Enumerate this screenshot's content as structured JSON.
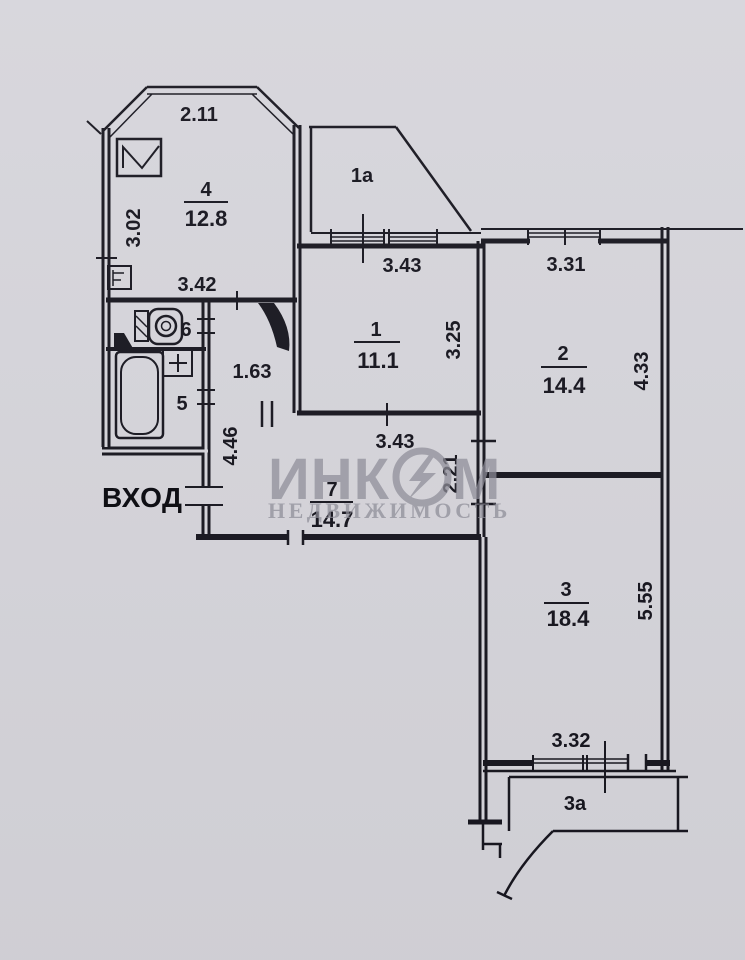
{
  "entrance_label": "ВХОД",
  "watermark": {
    "brand_full": "ИНКОМ",
    "brand_part1": "ИНК",
    "brand_part2": "М",
    "subtitle": "НЕДВИЖИМОСТЬ"
  },
  "rooms": {
    "r1": {
      "number": "1",
      "area": "11.1"
    },
    "r1a": {
      "number": "1a"
    },
    "r2": {
      "number": "2",
      "area": "14.4"
    },
    "r3": {
      "number": "3",
      "area": "18.4"
    },
    "r3a": {
      "number": "3a"
    },
    "r4": {
      "number": "4",
      "area": "12.8"
    },
    "r5": {
      "number": "5"
    },
    "r6": {
      "number": "6"
    },
    "r7": {
      "number": "7",
      "area": "14.7"
    }
  },
  "dimensions": {
    "room4_top": "2.11",
    "room4_left": "3.02",
    "room4_bottom": "3.42",
    "room1_top": "3.43",
    "room1_side": "3.25",
    "room2_top": "3.31",
    "room2_side": "4.33",
    "corridor_width": "1.63",
    "hall_side": "4.46",
    "room7_top": "3.43",
    "room7_side": "2.21",
    "room3_side": "5.55",
    "room3_bottom": "3.32"
  },
  "icons": {
    "kitchen_sink": "kitchen-sink-icon",
    "vent": "vent-icon",
    "toilet": "toilet-icon",
    "bathtub": "bathtub-icon",
    "washbasin": "washbasin-icon",
    "door_swing": "door-swing-icon",
    "brand_logo": "brand-logo-o-icon"
  },
  "colors": {
    "paper": "#d6d5db",
    "ink": "#17161f",
    "watermark": "#8e8d98",
    "entrance_text": "#09090f"
  }
}
